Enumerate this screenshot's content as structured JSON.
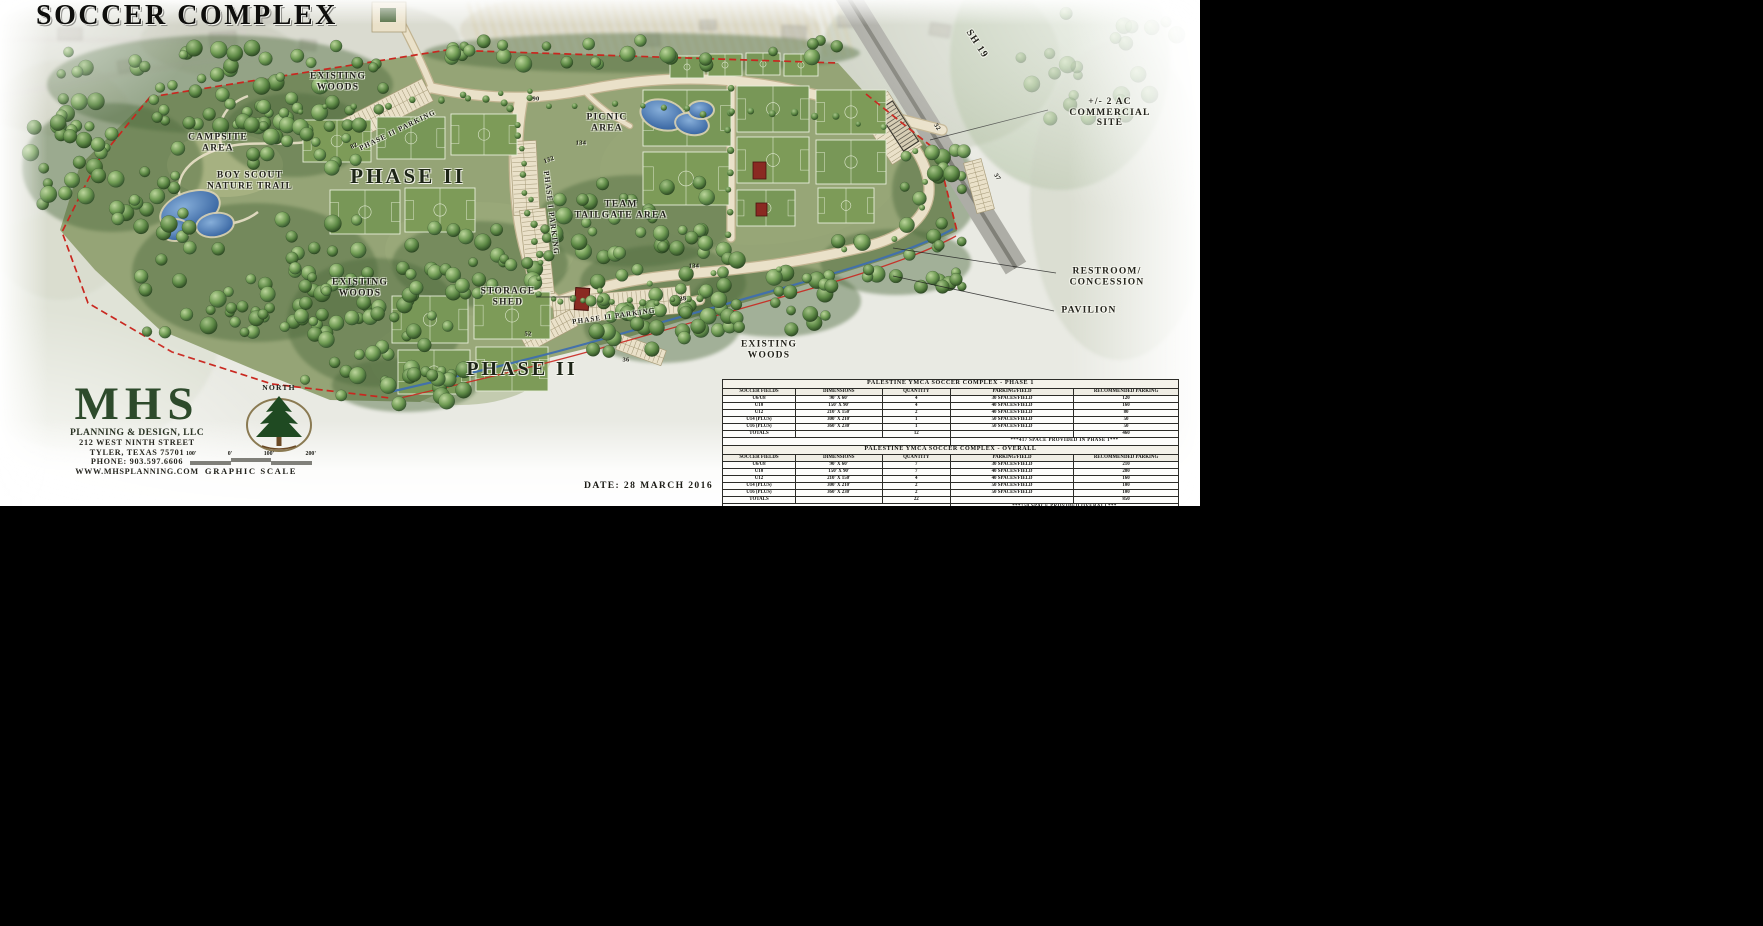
{
  "title": "SOCCER COMPLEX",
  "date_label": "DATE: 28 MARCH 2016",
  "firm": {
    "name": "MHS",
    "tagline": "PLANNING & DESIGN, LLC",
    "address1": "212 WEST NINTH STREET",
    "address2": "TYLER, TEXAS 75701",
    "phone": "PHONE: 903.597.6606",
    "website": "WWW.MHSPLANNING.COM"
  },
  "north_label": "NORTH",
  "graphic_scale": {
    "labels": [
      "100'",
      "0'",
      "100'",
      "200'"
    ],
    "caption": "GRAPHIC SCALE"
  },
  "colors": {
    "boundary_red": "#c9271f",
    "water_blue": "#3f6fae",
    "turf_green": "#95a476",
    "field_green": "#7d9b58",
    "road_cream": "#eae1c9",
    "road_edge": "#c2b491",
    "tree_dark": "#2f4f2a",
    "logo_green": "#2d4a2b",
    "highway_gray": "#adada6",
    "building_red": "#8a2a22"
  },
  "map_labels": [
    {
      "name": "existing-woods-north",
      "text": "EXISTING\nWOODS",
      "x": 338,
      "y": 82,
      "size": 9.5
    },
    {
      "name": "campsite-area",
      "text": "CAMPSITE\nAREA",
      "x": 218,
      "y": 143,
      "size": 9.5
    },
    {
      "name": "boy-scout-nature-trail",
      "text": "BOY SCOUT\nNATURE TRAIL",
      "x": 250,
      "y": 181,
      "size": 9.5
    },
    {
      "name": "phase-2-upper",
      "text": "PHASE II",
      "x": 408,
      "y": 177,
      "size": 21,
      "cls": "big"
    },
    {
      "name": "picnic-area",
      "text": "PICNIC\nAREA",
      "x": 607,
      "y": 123,
      "size": 9.5
    },
    {
      "name": "team-tailgate-area",
      "text": "TEAM\nTAILGATE AREA",
      "x": 621,
      "y": 210,
      "size": 9.5
    },
    {
      "name": "existing-woods-west",
      "text": "EXISTING\nWOODS",
      "x": 360,
      "y": 288,
      "size": 9.5
    },
    {
      "name": "storage-shed",
      "text": "STORAGE\nSHED",
      "x": 508,
      "y": 297,
      "size": 9.5
    },
    {
      "name": "phase-2-lower",
      "text": "PHASE II",
      "x": 522,
      "y": 369,
      "size": 20,
      "cls": "big"
    },
    {
      "name": "existing-woods-south",
      "text": "EXISTING\nWOODS",
      "x": 769,
      "y": 350,
      "size": 9.5
    },
    {
      "name": "restroom-concession",
      "text": "RESTROOM/\nCONCESSION",
      "x": 1107,
      "y": 277,
      "size": 9.5
    },
    {
      "name": "pavilion",
      "text": "PAVILION",
      "x": 1089,
      "y": 311,
      "size": 9.5
    },
    {
      "name": "commercial-site",
      "text": "+/- 2 AC\nCOMMERCIAL SITE",
      "x": 1110,
      "y": 113,
      "size": 9.5
    },
    {
      "name": "sh-19-highway",
      "text": "SH 19",
      "x": 977,
      "y": 44,
      "size": 10,
      "rotate": 57
    },
    {
      "name": "phase-1-parking",
      "text": "PHASE I PARKING",
      "x": 551,
      "y": 213,
      "size": 7.5,
      "rotate": 83
    },
    {
      "name": "phase-2-parking-north",
      "text": "PHASE II PARKING",
      "x": 398,
      "y": 131,
      "size": 7,
      "rotate": -26
    },
    {
      "name": "phase-2-parking-south",
      "text": "PHASE II PARKING",
      "x": 614,
      "y": 317,
      "size": 7,
      "rotate": -8
    }
  ],
  "road_numbers": [
    {
      "value": "90",
      "x": 536,
      "y": 99
    },
    {
      "value": "82",
      "x": 354,
      "y": 146,
      "rotate": -26
    },
    {
      "value": "134",
      "x": 581,
      "y": 143
    },
    {
      "value": "132",
      "x": 549,
      "y": 160,
      "rotate": -20
    },
    {
      "value": "134",
      "x": 694,
      "y": 266
    },
    {
      "value": "38",
      "x": 683,
      "y": 299,
      "rotate": -8
    },
    {
      "value": "52",
      "x": 528,
      "y": 334
    },
    {
      "value": "36",
      "x": 626,
      "y": 360
    },
    {
      "value": "32",
      "x": 937,
      "y": 127,
      "rotate": 57
    },
    {
      "value": "37",
      "x": 997,
      "y": 177,
      "rotate": 57
    }
  ],
  "tables": [
    {
      "title": "PALESTINE YMCA SOCCER COMPLEX - PHASE 1",
      "headers": [
        "SOCCER FIELDS",
        "DIMENSIONS",
        "QUANTITY",
        "PARKING/FIELD",
        "RECOMMENDED PARKING"
      ],
      "rows": [
        [
          "U6/U8",
          "90' X 60'",
          "4",
          "30 SPACES/FIELD",
          "120"
        ],
        [
          "U10",
          "150' X 90'",
          "4",
          "40 SPACES/FIELD",
          "160"
        ],
        [
          "U12",
          "210' X 150'",
          "2",
          "40 SPACES/FIELD",
          "80"
        ],
        [
          "U14 (PLUS)",
          "300' X 210'",
          "1",
          "50 SPACES/FIELD",
          "50"
        ],
        [
          "U16 (PLUS)",
          "360' X 230'",
          "1",
          "50 SPACES/FIELD",
          "50"
        ]
      ],
      "totals": [
        "TOTALS",
        "",
        "12",
        "",
        "460"
      ],
      "footnote": "***417 SPACE PROVIDED IN PHASE 1***"
    },
    {
      "title": "PALESTINE YMCA SOCCER COMPLEX - OVERALL",
      "headers": [
        "SOCCER FIELDS",
        "DIMENSIONS",
        "QUANTITY",
        "PARKING/FIELD",
        "RECOMMENDED PARKING"
      ],
      "rows": [
        [
          "U6/U8",
          "90' X 60'",
          "7",
          "30 SPACES/FIELD",
          "210"
        ],
        [
          "U10",
          "150' X 90'",
          "7",
          "40 SPACES/FIELD",
          "280"
        ],
        [
          "U12",
          "210' X 150'",
          "4",
          "40 SPACES/FIELD",
          "160"
        ],
        [
          "U14 (PLUS)",
          "300' X 210'",
          "2",
          "50 SPACES/FIELD",
          "100"
        ],
        [
          "U16 (PLUS)",
          "360' X 230'",
          "2",
          "50 SPACES/FIELD",
          "100"
        ]
      ],
      "totals": [
        "TOTALS",
        "",
        "22",
        "",
        "850"
      ],
      "footnote": "***750 SPACE PROVIDED OVERALL***"
    }
  ]
}
